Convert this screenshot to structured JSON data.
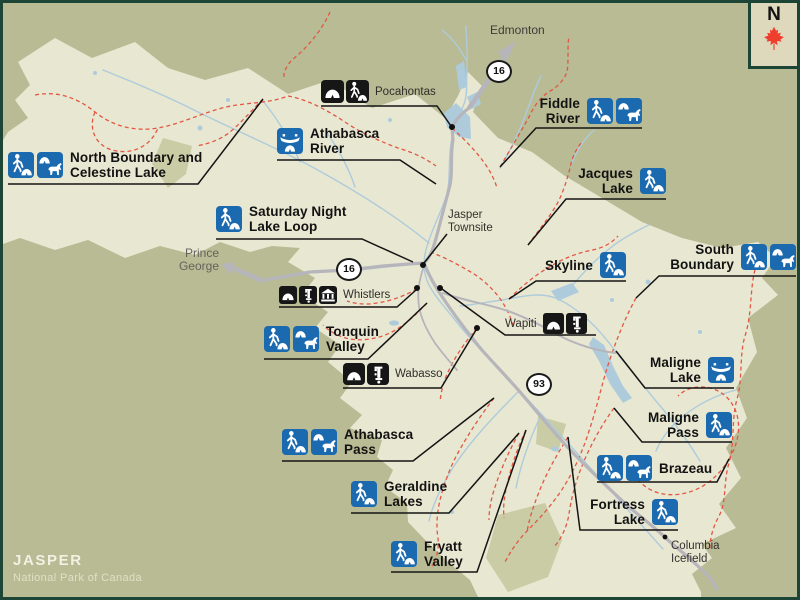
{
  "map": {
    "title": "JASPER",
    "subtitle": "National Park of Canada",
    "north_label": "N",
    "colors": {
      "frame": "#1c4536",
      "outside": "#b8bb94",
      "park": "#e8e7d1",
      "patch": "#c9cca5",
      "water": "#aecbdc",
      "road": "#b5b5bb",
      "trail": "#e25744",
      "iconblue": "#1b69af",
      "iconblack": "#161616",
      "leader": "#141414",
      "leaf": "#ef3e2d",
      "corner": "#ded9bd"
    }
  },
  "highway_shields": [
    {
      "number": "16",
      "x": 499,
      "y": 71
    },
    {
      "number": "16",
      "x": 349,
      "y": 269
    },
    {
      "number": "93",
      "x": 539,
      "y": 384
    }
  ],
  "trail_labels": [
    {
      "id": "north-boundary-celestine-lake",
      "lines": [
        "North Boundary and",
        "Celestine Lake"
      ],
      "icons": [
        "hike-camp",
        "horse-camp"
      ],
      "icons_side": "left",
      "x": 8,
      "top": 150,
      "underline": [
        8,
        198,
        184
      ],
      "leader": [
        263,
        99
      ],
      "leader_from": "right"
    },
    {
      "id": "athabasca-river",
      "lines": [
        "Athabasca",
        "River"
      ],
      "icons": [
        "canoe-camp"
      ],
      "icons_side": "left",
      "x": 277,
      "top": 126,
      "underline": [
        277,
        400,
        160
      ],
      "leader": [
        436,
        184
      ],
      "leader_from": "right"
    },
    {
      "id": "saturday-night-lake-loop",
      "lines": [
        "Saturday Night",
        "Lake Loop"
      ],
      "icons": [
        "hike-camp"
      ],
      "icons_side": "left",
      "x": 216,
      "top": 204,
      "underline": [
        216,
        362,
        239
      ],
      "leader": [
        413,
        262
      ],
      "leader_from": "right"
    },
    {
      "id": "fiddle-river",
      "lines": [
        "Fiddle",
        "River"
      ],
      "icons": [
        "hike-camp",
        "horse-camp"
      ],
      "icons_side": "right",
      "right": 642,
      "top": 96,
      "underline": [
        536,
        642,
        128
      ],
      "leader": [
        500,
        167
      ],
      "leader_from": "left"
    },
    {
      "id": "jacques-lake",
      "lines": [
        "Jacques",
        "Lake"
      ],
      "icons": [
        "hike-camp"
      ],
      "icons_side": "right",
      "right": 666,
      "top": 166,
      "underline": [
        566,
        666,
        199
      ],
      "leader": [
        528,
        245
      ],
      "leader_from": "left"
    },
    {
      "id": "skyline",
      "lines": [
        "Skyline"
      ],
      "icons": [
        "hike-camp"
      ],
      "icons_side": "right",
      "right": 626,
      "top": 252,
      "underline": [
        536,
        626,
        281
      ],
      "leader": [
        509,
        299
      ],
      "leader_from": "left"
    },
    {
      "id": "south-boundary",
      "lines": [
        "South",
        "Boundary"
      ],
      "icons": [
        "hike-camp",
        "horse-camp"
      ],
      "icons_side": "right",
      "right": 796,
      "top": 242,
      "underline": [
        659,
        796,
        276
      ],
      "leader": [
        636,
        298
      ],
      "leader_from": "left"
    },
    {
      "id": "tonquin-valley",
      "lines": [
        "Tonquin",
        "Valley"
      ],
      "icons": [
        "hike-camp",
        "horse-camp"
      ],
      "icons_side": "left",
      "x": 264,
      "top": 324,
      "underline": [
        264,
        368,
        359
      ],
      "leader": [
        427,
        303
      ],
      "leader_from": "right"
    },
    {
      "id": "maligne-lake",
      "lines": [
        "Maligne",
        "Lake"
      ],
      "icons": [
        "canoe-camp"
      ],
      "icons_side": "right",
      "right": 734,
      "top": 355,
      "underline": [
        645,
        734,
        388
      ],
      "leader": [
        616,
        351
      ],
      "leader_from": "left"
    },
    {
      "id": "maligne-pass",
      "lines": [
        "Maligne",
        "Pass"
      ],
      "icons": [
        "hike-camp"
      ],
      "icons_side": "right",
      "right": 732,
      "top": 410,
      "underline": [
        642,
        732,
        442
      ],
      "leader": [
        614,
        408
      ],
      "leader_from": "left"
    },
    {
      "id": "athabasca-pass",
      "lines": [
        "Athabasca",
        "Pass"
      ],
      "icons": [
        "hike-camp",
        "horse-camp"
      ],
      "icons_side": "left",
      "x": 282,
      "top": 427,
      "underline": [
        282,
        413,
        461
      ],
      "leader": [
        494,
        398
      ],
      "leader_from": "right"
    },
    {
      "id": "brazeau",
      "lines": [
        "Brazeau"
      ],
      "icons": [
        "hike-camp",
        "horse-camp"
      ],
      "icons_side": "left",
      "x": 597,
      "top": 455,
      "underline": [
        597,
        717,
        482
      ],
      "leader": [
        729,
        459
      ],
      "leader_from": "right"
    },
    {
      "id": "geraldine-lakes",
      "lines": [
        "Geraldine",
        "Lakes"
      ],
      "icons": [
        "hike-camp"
      ],
      "icons_side": "left",
      "x": 351,
      "top": 479,
      "underline": [
        351,
        449,
        513
      ],
      "leader": [
        519,
        433
      ],
      "leader_from": "right"
    },
    {
      "id": "fortress-lake",
      "lines": [
        "Fortress",
        "Lake"
      ],
      "icons": [
        "hike-camp"
      ],
      "icons_side": "right",
      "right": 678,
      "top": 497,
      "underline": [
        580,
        678,
        530
      ],
      "leader": [
        568,
        437
      ],
      "leader_from": "left"
    },
    {
      "id": "fryatt-valley",
      "lines": [
        "Fryatt",
        "Valley"
      ],
      "icons": [
        "hike-camp"
      ],
      "icons_side": "left",
      "x": 391,
      "top": 539,
      "underline": [
        391,
        477,
        572
      ],
      "leader": [
        526,
        430
      ],
      "leader_from": "right"
    }
  ],
  "facility_labels": [
    {
      "id": "pocahontas",
      "text": "Pocahontas",
      "icons": [
        "camp",
        "hike-camp"
      ],
      "order": "icons-first",
      "x": 321,
      "top": 80,
      "size": 23,
      "underline": [
        321,
        437,
        106
      ],
      "leader": [
        451,
        126
      ],
      "leader_from": "right"
    },
    {
      "id": "whistlers",
      "text": "Whistlers",
      "icons": [
        "camp",
        "water-pump",
        "building"
      ],
      "order": "icons-first",
      "x": 279,
      "top": 286,
      "size": 18,
      "underline": [
        279,
        397,
        307
      ],
      "leader": [
        416,
        290
      ],
      "leader_from": "right"
    },
    {
      "id": "wapiti",
      "text": "Wapiti",
      "icons": [
        "camp",
        "water-pump"
      ],
      "order": "text-first",
      "x": 505,
      "top": 313,
      "size": 21,
      "underline": [
        505,
        596,
        335
      ],
      "leader": [
        442,
        289
      ],
      "leader_from": "left"
    },
    {
      "id": "wabasso",
      "text": "Wabasso",
      "icons": [
        "camp",
        "water-pump"
      ],
      "order": "icons-first",
      "x": 343,
      "top": 363,
      "size": 22,
      "underline": [
        343,
        441,
        388
      ],
      "leader": [
        476,
        330
      ],
      "leader_from": "right"
    }
  ],
  "place_labels": [
    {
      "id": "edmonton",
      "lines": [
        "Edmonton"
      ],
      "x": 490,
      "top": 24,
      "style": "big"
    },
    {
      "id": "prince-george",
      "lines": [
        "Prince",
        "George"
      ],
      "right": 219,
      "top": 247,
      "style": "gray",
      "align": "right"
    },
    {
      "id": "jasper-townsite",
      "lines": [
        "Jasper",
        "Townsite"
      ],
      "x": 448,
      "top": 209,
      "style": ""
    },
    {
      "id": "columbia-icefield",
      "lines": [
        "Columbia",
        "Icefield"
      ],
      "x": 671,
      "top": 540,
      "style": ""
    }
  ],
  "markers": [
    {
      "name": "pocahontas-marker",
      "x": 452,
      "y": 127,
      "r": 3
    },
    {
      "name": "jasper-townsite-marker",
      "x": 423,
      "y": 265,
      "r": 3
    },
    {
      "name": "whistlers-marker",
      "x": 417,
      "y": 288,
      "r": 3
    },
    {
      "name": "wapiti-marker",
      "x": 440,
      "y": 288,
      "r": 3
    },
    {
      "name": "wabasso-marker",
      "x": 477,
      "y": 328,
      "r": 3
    },
    {
      "name": "columbia-icefield-marker",
      "x": 665,
      "y": 537,
      "r": 2.4
    }
  ]
}
